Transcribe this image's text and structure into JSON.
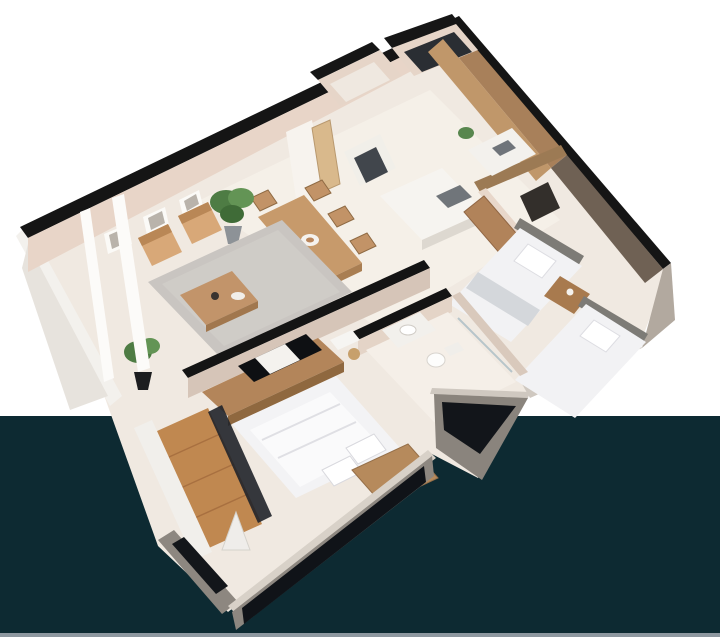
{
  "scene": {
    "kind": "isometric-3d-floor-plan-render",
    "apartment_type": "two-bedroom-apartment",
    "has_text": false
  },
  "palette": {
    "background_top": "#ffffff",
    "background_bottom": "#0d2a32",
    "footer_strip": "#8e98a0",
    "wall_top_edge": "#151515",
    "wall_face_light": "#e8d5c8",
    "wall_face_shade": "#d6c4b7",
    "wall_taupe_dark": "#6f6154",
    "exterior_grey": "#8d8780",
    "floor_cream": "#f0e9e1",
    "floor_light": "#f6f1ea",
    "wood_mid": "#c49a6c",
    "wood_dark": "#a87c50",
    "deck_wood": "#c08850",
    "rug_grey": "#c9c5c1",
    "bed_white": "#f3f3f5",
    "glass_black": "#12151a",
    "plant_green": "#4e7c44"
  },
  "rooms": [
    {
      "name": "living-room",
      "furniture": [
        "two-wood-armchairs",
        "grey-rug",
        "coffee-table",
        "three-wall-frames",
        "tall-potted-plant",
        "window-posts"
      ]
    },
    {
      "name": "dining-area",
      "furniture": [
        "wood-dining-table",
        "dining-chairs",
        "white-bowl"
      ]
    },
    {
      "name": "kitchen",
      "furniture": [
        "wood-wall-cabinets",
        "white-island-counter",
        "cooktop",
        "fridge",
        "small-plant"
      ]
    },
    {
      "name": "entry-hall",
      "furniture": [
        "entry-door",
        "storage-closets",
        "dark-shelf"
      ]
    },
    {
      "name": "bedroom-twin",
      "furniture": [
        "single-bed-1",
        "single-bed-2",
        "nightstand",
        "wood-wardrobe-row",
        "black-window"
      ]
    },
    {
      "name": "bathroom",
      "furniture": [
        "sink-counter",
        "toilet",
        "shower-glass"
      ]
    },
    {
      "name": "bedroom-master",
      "furniture": [
        "double-bed",
        "pillows",
        "wood-wardrobe",
        "tv-console",
        "tv",
        "desk",
        "balcony-wood-deck",
        "tripod-lamp",
        "rail-plant",
        "black-window-band"
      ]
    }
  ]
}
